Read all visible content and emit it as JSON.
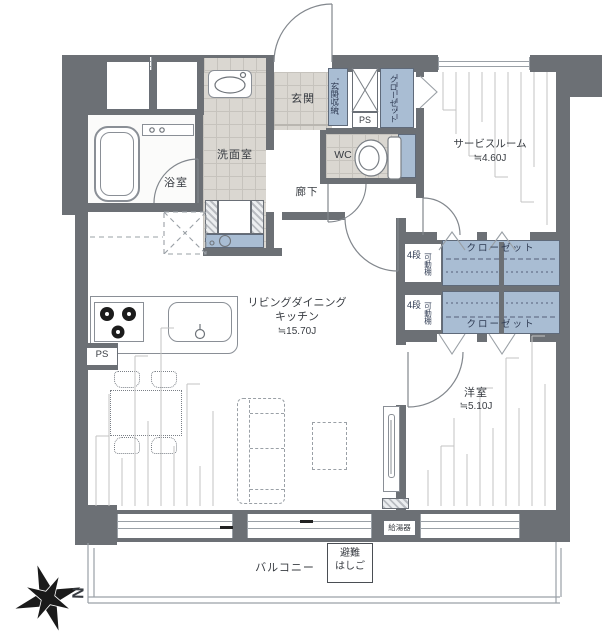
{
  "rooms": {
    "entrance": {
      "label": "玄関"
    },
    "entrance_storage": {
      "label": "玄関収納"
    },
    "pipe_space_upper": {
      "label": "PS"
    },
    "hall_closet": {
      "label": "クローゼット"
    },
    "toilet_room": {
      "label": "WC"
    },
    "washroom": {
      "label": "洗面室"
    },
    "bathroom": {
      "label": "浴室"
    },
    "hallway": {
      "label": "廊下"
    },
    "service_room": {
      "label": "サービスルーム",
      "size": "≒4.60J"
    },
    "closet_upper": {
      "label": "クローゼット",
      "steps": "4段",
      "shelf": "可動棚"
    },
    "closet_lower": {
      "label": "クローゼット",
      "steps": "4段",
      "shelf": "可動棚"
    },
    "living_dining_kitchen": {
      "label_line1": "リビングダイニング",
      "label_line2": "キッチン",
      "size": "≒15.70J"
    },
    "pipe_space_kitchen": {
      "label": "PS"
    },
    "western_room": {
      "label": "洋室",
      "size": "≒5.10J"
    },
    "water_heater": {
      "label": "給湯器"
    },
    "balcony": {
      "label": "バルコニー"
    },
    "escape_ladder": {
      "label_line1": "避難",
      "label_line2": "はしご"
    }
  },
  "compass": {
    "north_label": "N"
  },
  "colors": {
    "wall": "#6c7075",
    "tile_floor": "#dad7d1",
    "storage_blue": "#a9bdd3",
    "fixture_line": "#8a8f96",
    "text": "#383c42",
    "storage_text": "#2e3a52"
  }
}
